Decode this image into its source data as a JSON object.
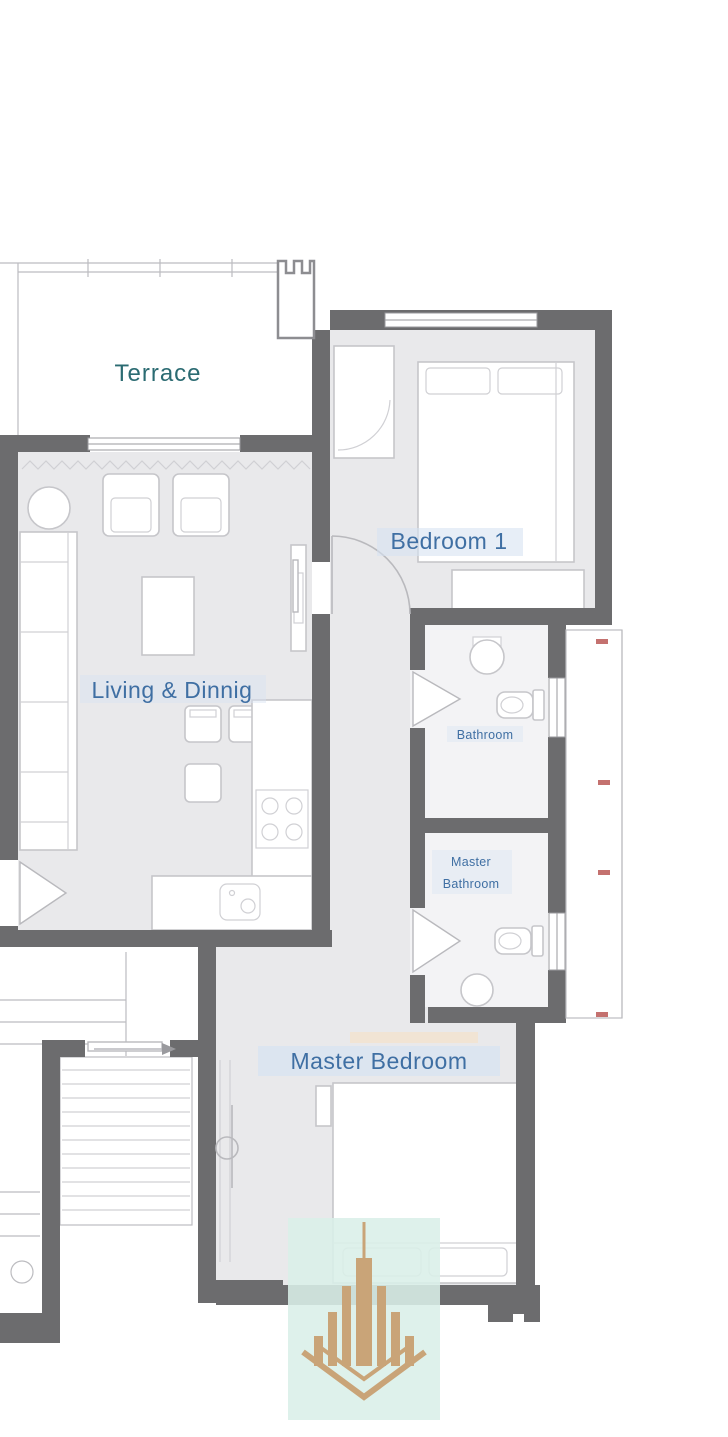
{
  "floor_plan": {
    "rooms": {
      "terrace": {
        "label": "Terrace"
      },
      "bedroom_1": {
        "label": "Bedroom 1"
      },
      "living_dining": {
        "label": "Living & Dinnig"
      },
      "bathroom": {
        "label": "Bathroom"
      },
      "master_bathroom": {
        "label_line1": "Master",
        "label_line2": "Bathroom"
      },
      "master_bedroom": {
        "label": "Master Bedroom"
      }
    },
    "colors": {
      "background": "#ffffff",
      "wall": "#6c6c6e",
      "floor": "#e9e9eb",
      "bath_floor": "#f3f3f5",
      "label_blue": "#3f6fa3",
      "label_teal": "#2b6b72",
      "label_highlight": "#d7e3f2",
      "window_marker_red": "#c4716f",
      "logo_gold": "#c9a478",
      "logo_background": "#d9efe8"
    },
    "watermark": {
      "icon": "tower-building-logo"
    }
  }
}
